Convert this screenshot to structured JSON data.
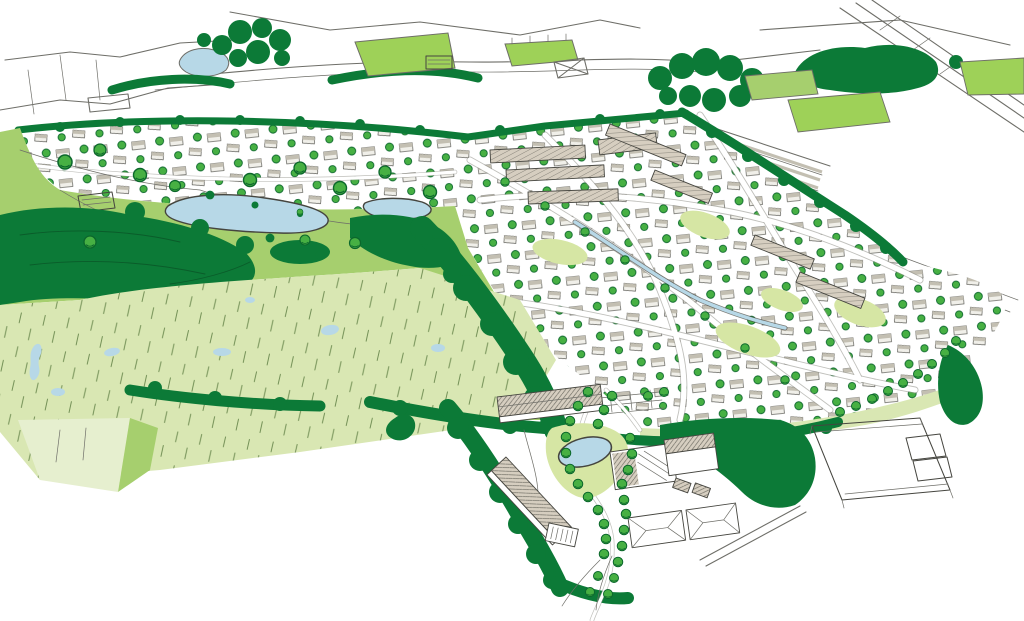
{
  "meta": {
    "kind": "hand-drawn aerial masterplan illustration",
    "view": "bird's-eye perspective of a planned settlement extension beside open countryside",
    "visible_text": "none"
  },
  "palette": {
    "background": "#ffffff",
    "ink": "#45453f",
    "sketch": "#6e6e68",
    "road": "#8c8c85",
    "dark_green": "#0c7a37",
    "wood_line": "#0a5c2a",
    "mid_green": "#a6cf6e",
    "bright_green": "#9ed158",
    "pale_green": "#d9e7b3",
    "pale_green_light": "#e6efcf",
    "courtyard_green": "#d6e6a4",
    "water": "#b7d8e7",
    "tree": "#47b043",
    "tree_stroke": "#0b672c",
    "roof_beige": "#d6cec0",
    "roof_grey": "#c3bfb2",
    "wall": "#f0efe9",
    "hatch_line": "#55544c"
  },
  "scene": {
    "regions": [
      {
        "name": "existing-countryside-sketch",
        "style": "uncoloured outline line work",
        "fill": "background"
      },
      {
        "name": "sports-pitches",
        "fill": "bright_green"
      },
      {
        "name": "railway-sidings",
        "fill": "roof_grey"
      },
      {
        "name": "new-housing-area",
        "style": "dense small houses with street trees",
        "fill": "background"
      },
      {
        "name": "terraced-blocks",
        "fill": "roof_beige"
      },
      {
        "name": "parkland",
        "fill": "mid_green"
      },
      {
        "name": "meadow-fields",
        "fill": "pale_green"
      },
      {
        "name": "woodland-and-hedgerows",
        "fill": "dark_green"
      },
      {
        "name": "ponds-and-stream",
        "fill": "water"
      },
      {
        "name": "employment-area-warehouses",
        "fill": "roof_beige"
      },
      {
        "name": "existing-industrial-outline",
        "fill": "background"
      }
    ]
  }
}
